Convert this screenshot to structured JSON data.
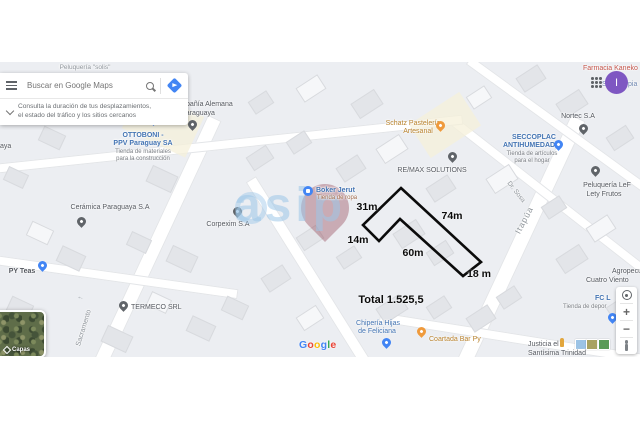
{
  "search": {
    "placeholder": "Buscar en Google Maps",
    "suggestion_line1": "Consulta la duración de tus desplazamientos,",
    "suggestion_line2": "el estado del tráfico y los sitios cercanos"
  },
  "account": {
    "avatar_letter": "I"
  },
  "measurements": {
    "side_31": "31m",
    "side_74": "74m",
    "side_14": "14m",
    "side_60": "60m",
    "side_18": "18 m",
    "total": "Total 1.525,5"
  },
  "watermark": {
    "text": "asip"
  },
  "map_controls": {
    "zoom_in": "+",
    "zoom_out": "−"
  },
  "layers": {
    "label": "Capas"
  },
  "google_logo": {
    "l0": "G",
    "l1": "o",
    "l2": "o",
    "l3": "g",
    "l4": "l",
    "l5": "e"
  },
  "streets": {
    "sacramento": "Sacramento",
    "itapua": "Itapúa",
    "dr_sosa": "Dr.  Sosa"
  },
  "places": {
    "peluqueria_solis": "Peluquería \"solis\"",
    "ottoboni_1": "OTTOBONI -",
    "ottoboni_2": "PPV Paraguay SA",
    "ottoboni_sub1": "Tienda de materiales",
    "ottoboni_sub2": "para la construcción",
    "alemana_1": "Compañía Alemana",
    "alemana_2": "Paraguaya",
    "ceramica": "Cerámica Paraguaya S.A",
    "corpexim": "Corpexim S.A",
    "py_teas": "PY Teas",
    "termeco": "TERMECO SRL",
    "boker": "Boker Jerut",
    "boker_sub": "Tienda de ropa",
    "schatz_1": "Schatz Pastelería",
    "schatz_2": "Artesanal",
    "remax": "RE/MAX SOLUTIONS",
    "nortec": "Nortec S.A",
    "seccoplac_1": "SECCOPLAC",
    "seccoplac_2": "ANTIHUMEDAD",
    "seccoplac_sub1": "Tienda de artículos",
    "seccoplac_sub2": "para el hogar",
    "farmacia": "Farmacia Kaneko",
    "frag_se": "Se",
    "frag_pia": "pia",
    "pelu_lef_1": "Peluquería LeF",
    "pelu_lef_2": "Lety Frutos",
    "agro_1": "Agropecua",
    "agro_2": "Cuatro Viento",
    "fc_1": "FC L",
    "fc_sub": "Tienda de depor",
    "justicia_1": "Justicia el",
    "justicia_2": "Santísima Trinidad",
    "coartada": "Coartada Bar Py",
    "chiperia_1": "Chipería Hijas",
    "chiperia_2": "de Feliciana",
    "frag_aya": "aya"
  },
  "colors": {
    "accent_blue": "#4285f4",
    "store_blue": "#4374b3",
    "food_orange": "#b9832e",
    "health_red": "#c4544a",
    "avatar_purple": "#7e57c2",
    "polygon_black": "#0b0b0b"
  }
}
